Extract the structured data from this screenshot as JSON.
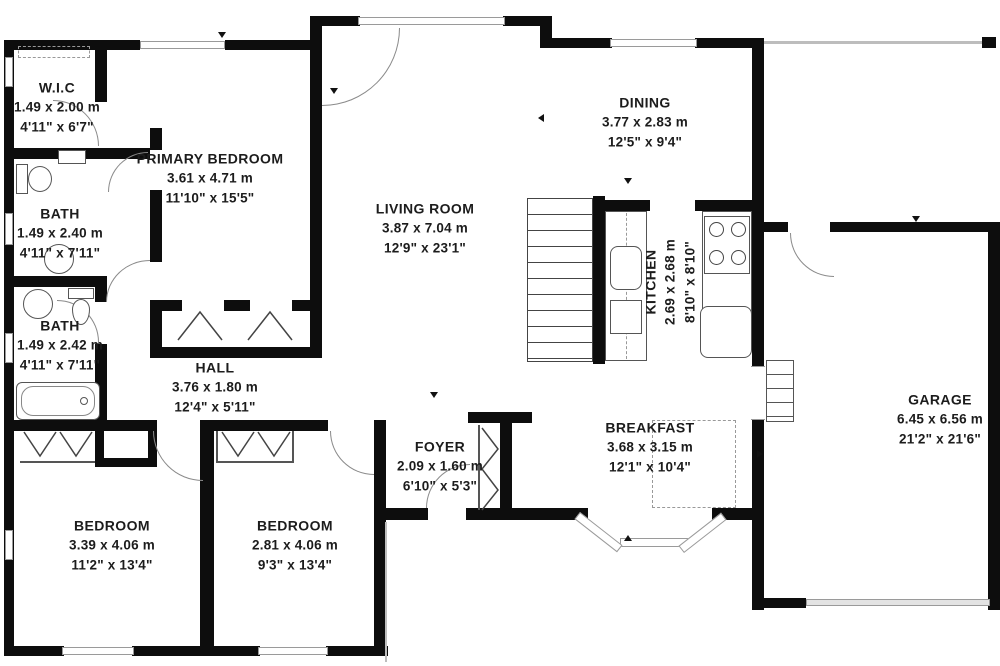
{
  "plan": {
    "colors": {
      "wall": "#0d0d0d",
      "door_arc": "#8a8a8a",
      "window_border": "#9a9a9a",
      "text": "#1c1c1c"
    },
    "rooms": [
      {
        "id": "wic",
        "name": "W.I.C",
        "metric": "1.49 x 2.00 m",
        "imperial": "4'11\" x 6'7\""
      },
      {
        "id": "primary-bedroom",
        "name": "PRIMARY BEDROOM",
        "metric": "3.61 x 4.71 m",
        "imperial": "11'10\" x 15'5\""
      },
      {
        "id": "bath-1",
        "name": "BATH",
        "metric": "1.49 x 2.40 m",
        "imperial": "4'11\" x 7'11\""
      },
      {
        "id": "bath-2",
        "name": "BATH",
        "metric": "1.49 x 2.42 m",
        "imperial": "4'11\" x 7'11\""
      },
      {
        "id": "hall",
        "name": "HALL",
        "metric": "3.76 x 1.80 m",
        "imperial": "12'4\" x 5'11\""
      },
      {
        "id": "living-room",
        "name": "LIVING ROOM",
        "metric": "3.87 x 7.04 m",
        "imperial": "12'9\" x 23'1\""
      },
      {
        "id": "dining",
        "name": "DINING",
        "metric": "3.77 x 2.83 m",
        "imperial": "12'5\" x 9'4\""
      },
      {
        "id": "kitchen",
        "name": "KITCHEN",
        "metric": "2.69 x 2.68 m",
        "imperial": "8'10\" x 8'10\""
      },
      {
        "id": "breakfast",
        "name": "BREAKFAST",
        "metric": "3.68 x 3.15 m",
        "imperial": "12'1\" x 10'4\""
      },
      {
        "id": "foyer",
        "name": "FOYER",
        "metric": "2.09 x 1.60 m",
        "imperial": "6'10\" x 5'3\""
      },
      {
        "id": "bedroom-1",
        "name": "BEDROOM",
        "metric": "3.39 x 4.06 m",
        "imperial": "11'2\" x 13'4\""
      },
      {
        "id": "bedroom-2",
        "name": "BEDROOM",
        "metric": "2.81 x 4.06 m",
        "imperial": "9'3\" x 13'4\""
      },
      {
        "id": "garage",
        "name": "GARAGE",
        "metric": "6.45 x 6.56 m",
        "imperial": "21'2\" x 21'6\""
      }
    ]
  }
}
